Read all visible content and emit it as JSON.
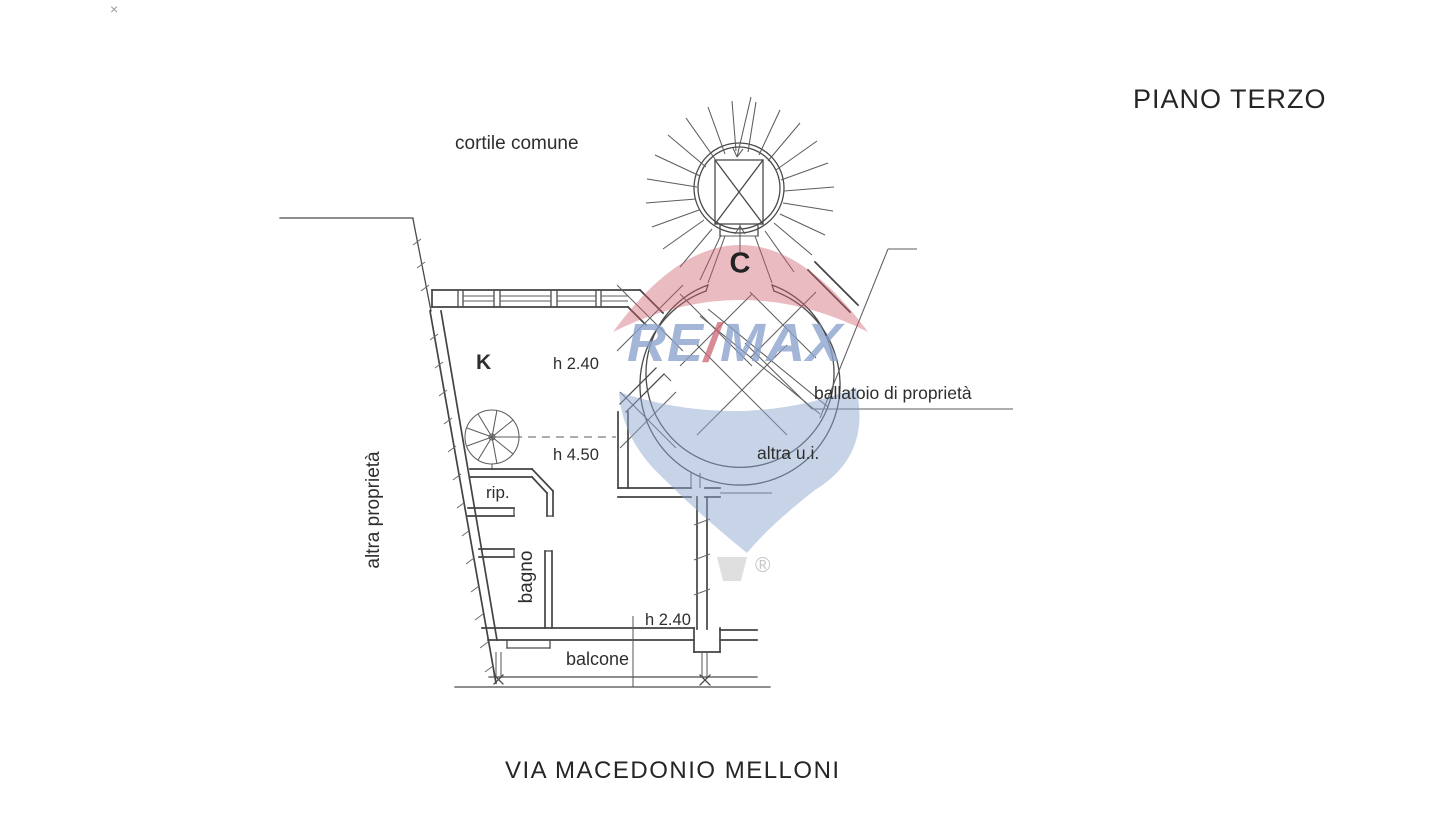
{
  "title": "PIANO TERZO",
  "street_name": "VIA MACEDONIO MELLONI",
  "plan_labels": {
    "courtyard": "cortile comune",
    "stairwell_letter": "C",
    "kitchen": "K",
    "height_upper": "h 2.40",
    "height_double": "h 4.50",
    "gallery": "ballatoio di proprietà",
    "other_unit": "altra u.i.",
    "other_property": "altra proprietà",
    "storage": "rip.",
    "bathroom": "bagno",
    "height_lower": "h 2.40",
    "balcony": "balcone"
  },
  "watermark": {
    "re": "RE",
    "slash": "/",
    "max": "MAX",
    "registered": "®"
  },
  "stray_mark": "×",
  "colors": {
    "plan_line": "#4a4a4a",
    "text": "#2e2e2e",
    "watermark_red": "#cd5f6e",
    "watermark_blue": "#8aa2cc",
    "watermark_basket_gray": "#dcdcdc"
  }
}
